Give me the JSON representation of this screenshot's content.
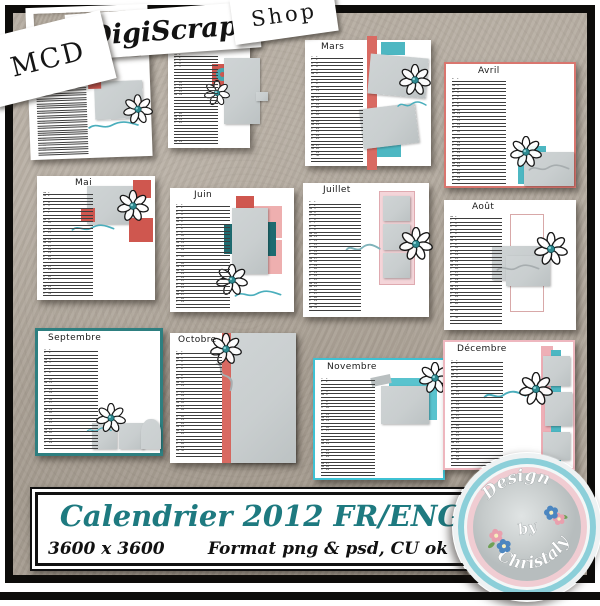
{
  "header": {
    "mcd_slip": "MCD",
    "digiscrap_banner": "DigiScrap",
    "shop_strip": "Shop"
  },
  "calendar": {
    "year": "2012",
    "day_abbrevs": [
      "D",
      "L",
      "Ma",
      "Me",
      "J",
      "V",
      "S"
    ],
    "months": [
      {
        "label": "Janvier",
        "days": 31,
        "start_dow": 0
      },
      {
        "label": "Février",
        "days": 29,
        "start_dow": 3
      },
      {
        "label": "Mars",
        "days": 31,
        "start_dow": 4
      },
      {
        "label": "Avril",
        "days": 30,
        "start_dow": 0
      },
      {
        "label": "Mai",
        "days": 31,
        "start_dow": 2
      },
      {
        "label": "Juin",
        "days": 30,
        "start_dow": 5
      },
      {
        "label": "Juillet",
        "days": 31,
        "start_dow": 0
      },
      {
        "label": "Août",
        "days": 31,
        "start_dow": 3
      },
      {
        "label": "Septembre",
        "days": 30,
        "start_dow": 6
      },
      {
        "label": "Octobre",
        "days": 31,
        "start_dow": 1
      },
      {
        "label": "Novembre",
        "days": 30,
        "start_dow": 4
      },
      {
        "label": "Décembre",
        "days": 31,
        "start_dow": 6
      }
    ]
  },
  "banner": {
    "title": "Calendrier 2012 FR/ENG",
    "size_text": "3600 x 3600",
    "format_text": "Format png & psd, CU ok"
  },
  "badge": {
    "word1": "Design",
    "word2": "by",
    "word3": "Christaly"
  },
  "colors": {
    "coral": "#cf574f",
    "pink": "#eeafaf",
    "pink_light": "#f4d5d9",
    "teal": "#4db7c2",
    "teal_dark": "#1e6b70",
    "teal_text": "#1e7a80",
    "photo_gray": "#c9cecf",
    "taupe": "#b3aa9e"
  }
}
